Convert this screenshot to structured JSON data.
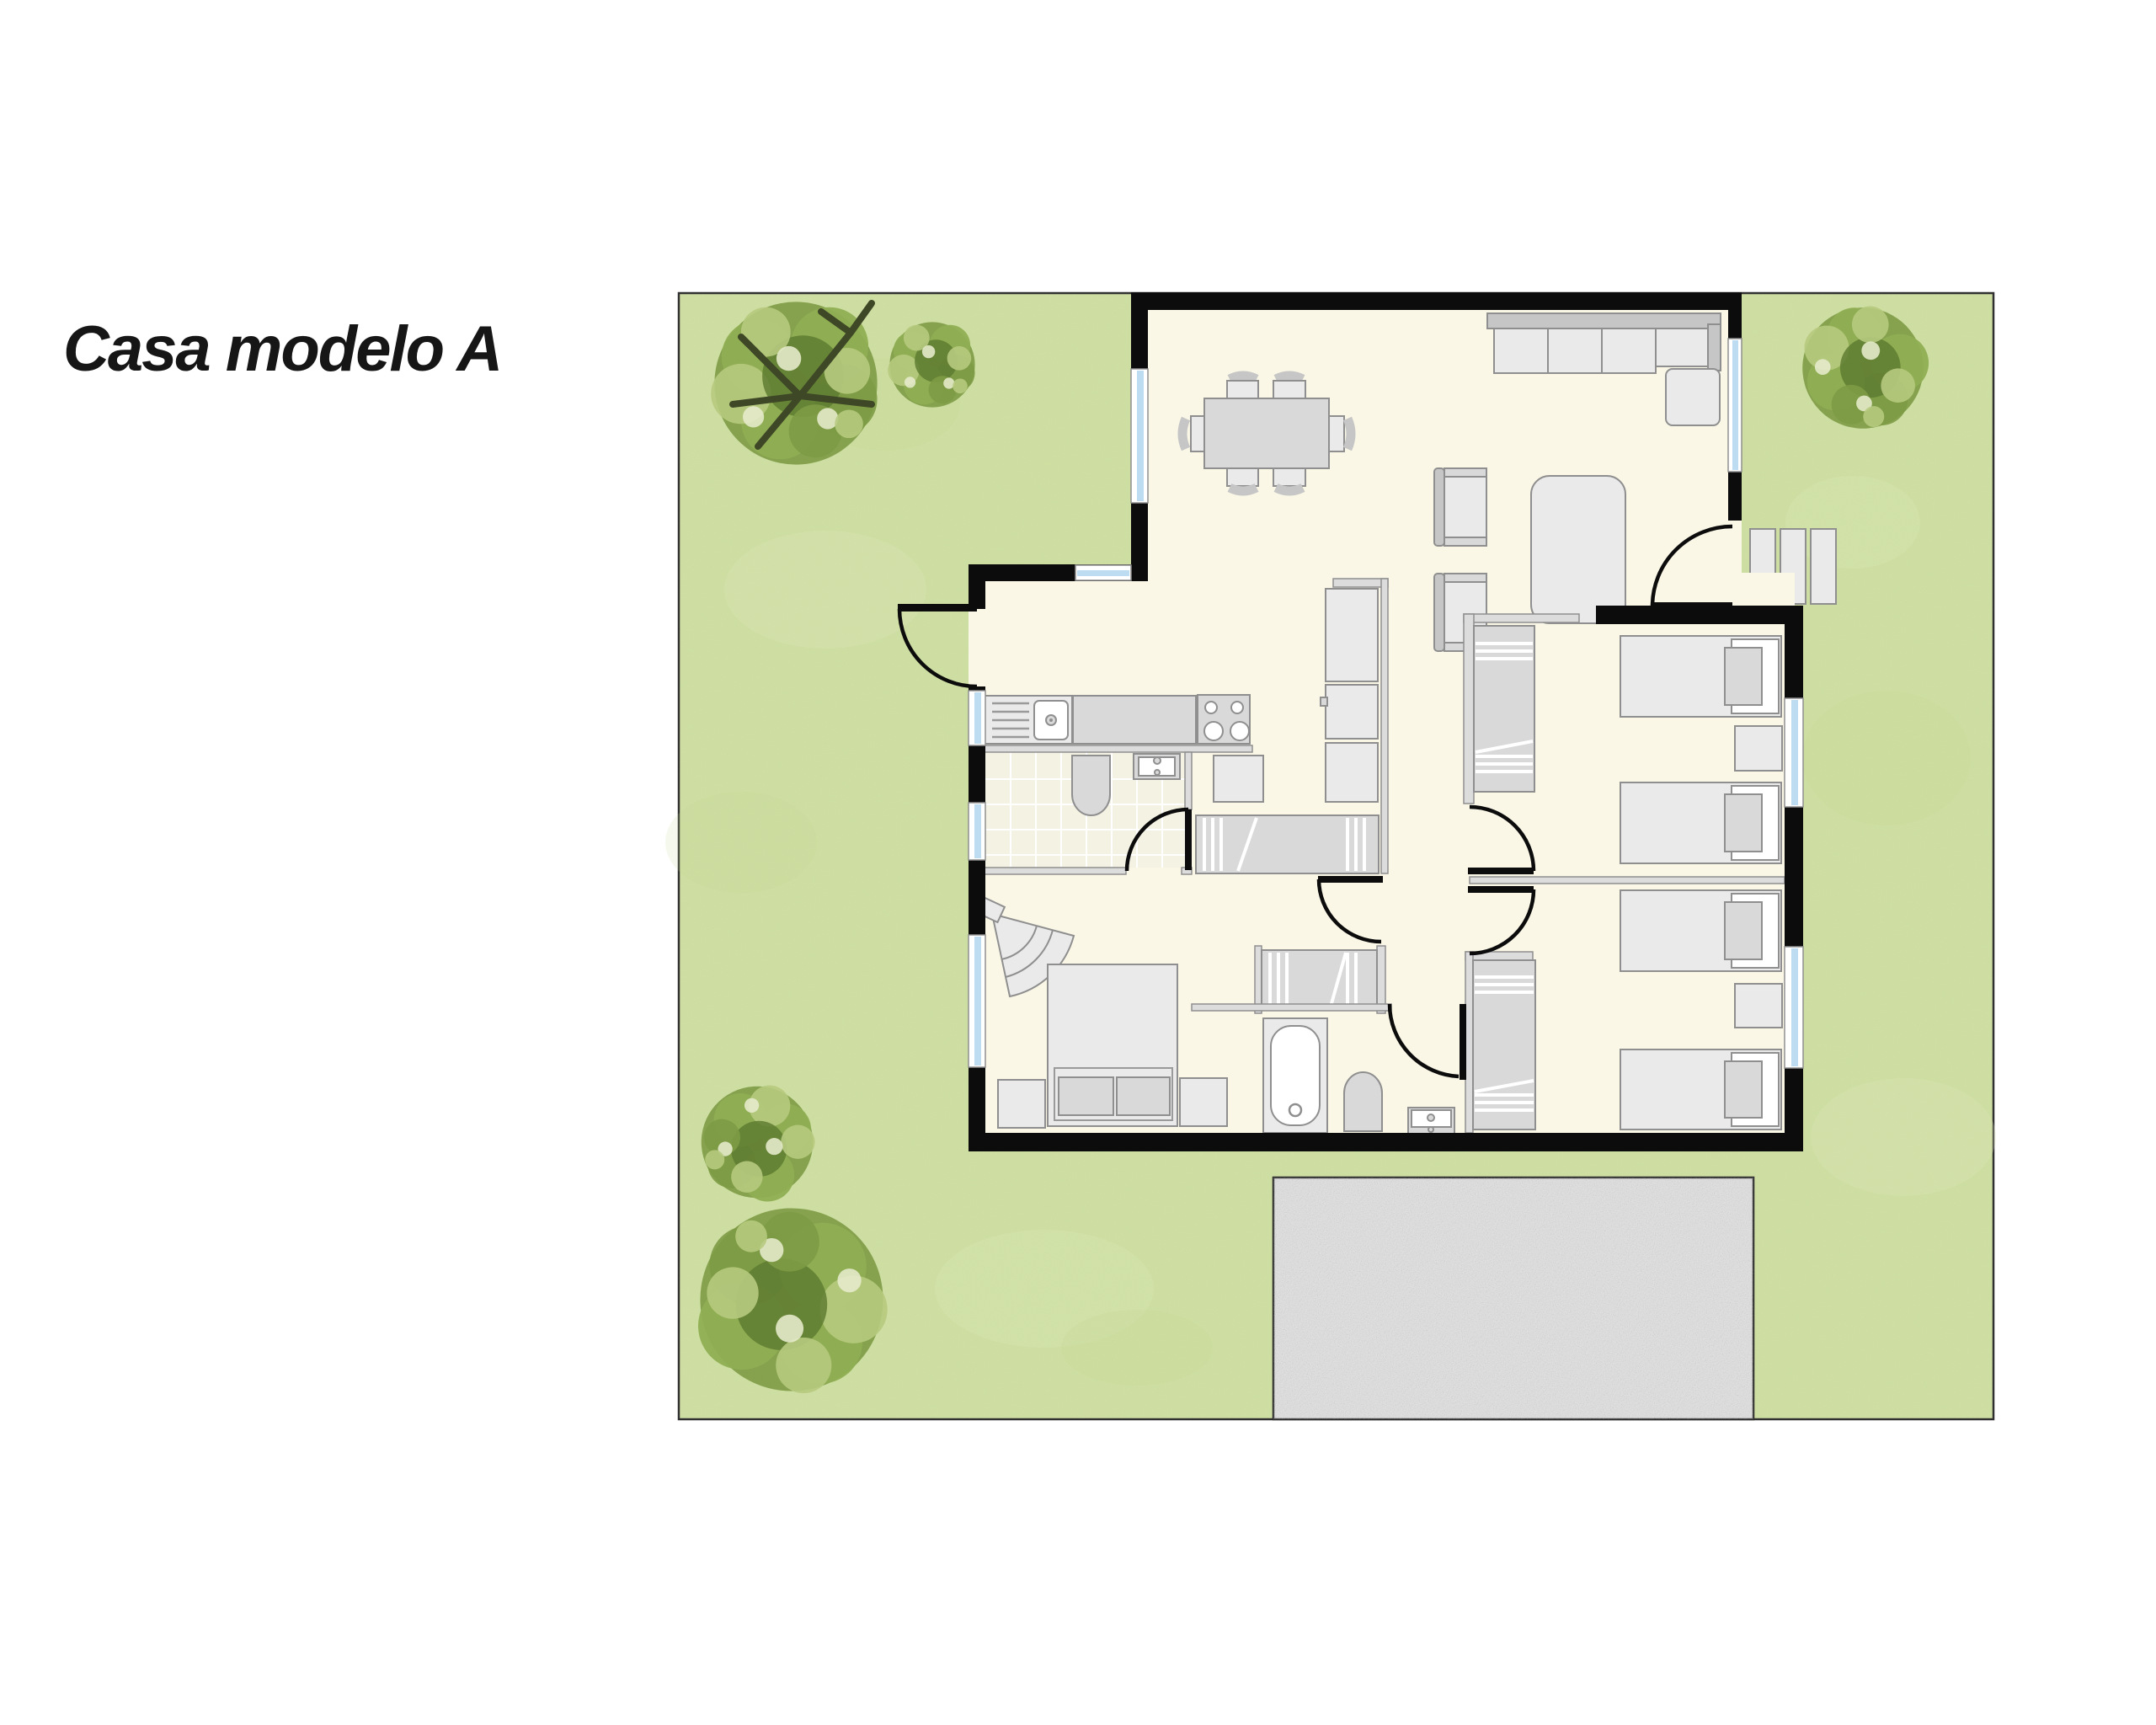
{
  "title": "Casa modelo A",
  "colors": {
    "page_bg": "#ffffff",
    "grass": "#cfe0a2",
    "grass_light": "#dfeabc",
    "grass_dark": "#c2d690",
    "lot_border": "#2e2e2e",
    "wall": "#0c0c0c",
    "floor": "#faf7e6",
    "tile": "#f4f2e3",
    "tile_line": "#ffffff",
    "thin_wall": "#dcdcdc",
    "outline": "#8f8f8f",
    "furn_light": "#eaeaea",
    "furn_mid": "#d9d9d9",
    "furn_dark": "#c6c6c6",
    "pure_white": "#ffffff",
    "window_blue": "#bddcf2",
    "driveway": "#e4e4e4",
    "tree_base": "#8fae52",
    "tree_mid": "#7d9b45",
    "tree_dark": "#5f7c31",
    "tree_light": "#b6ca7e",
    "tree_pale": "#e4eaca",
    "tree_branch": "#3e4726",
    "title_color": "#161616"
  },
  "summary": {
    "model_label": "Casa modelo A",
    "bedrooms": 3,
    "bathrooms": 2,
    "double_beds": 1,
    "single_beds": 4,
    "dining_seats": 6,
    "sofa": "L-shaped sectional",
    "trees": 5,
    "entry_steps": 3,
    "parking": "driveway"
  }
}
